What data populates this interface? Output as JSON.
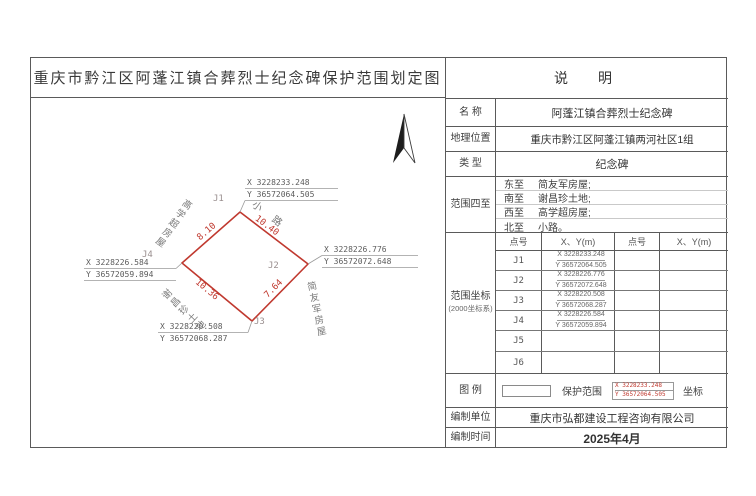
{
  "page": {
    "title": "重庆市黔江区阿蓬江镇合葬烈士纪念碑保护范围划定图"
  },
  "map": {
    "north_arrow": "north-arrow",
    "points": [
      {
        "id": "J1",
        "x": "X 3228233.248",
        "y": "Y 36572064.505"
      },
      {
        "id": "J2",
        "x": "X 3228226.776",
        "y": "Y 36572072.648"
      },
      {
        "id": "J3",
        "x": "X 3228220.508",
        "y": "Y 36572068.287"
      },
      {
        "id": "J4",
        "x": "X 3228226.584",
        "y": "Y 36572059.894"
      },
      {
        "id": "J5",
        "x": "",
        "y": ""
      },
      {
        "id": "J6",
        "x": "",
        "y": ""
      }
    ],
    "dimensions": {
      "j1_j2": "10.40",
      "j2_j3": "7.64",
      "j3_j4": "10.36",
      "j4_j1": "8.10"
    },
    "neighbors": {
      "north": "小  路",
      "east": "简友军房屋",
      "south": "谢昌珍土地",
      "west": "高学超房屋"
    }
  },
  "panel": {
    "header": "说　明",
    "name_label": "名 称",
    "name_value": "阿蓬江镇合葬烈士纪念碑",
    "location_label": "地理位置",
    "location_value": "重庆市黔江区阿蓬江镇两河社区1组",
    "type_label": "类 型",
    "type_value": "纪念碑",
    "boundary_label": "范围四至",
    "boundary_rows": [
      {
        "dir": "东至",
        "value": "简友军房屋;"
      },
      {
        "dir": "南至",
        "value": "谢昌珍土地;"
      },
      {
        "dir": "西至",
        "value": "高学超房屋;"
      },
      {
        "dir": "北至",
        "value": "小路。"
      }
    ],
    "coords_label_line1": "范围坐标",
    "coords_label_line2": "(2000坐标系)",
    "coords_header": {
      "point": "点号",
      "xy": "X、Y(m)",
      "point2": "点号",
      "xy2": "X、Y(m)"
    },
    "legend_label": "图 例",
    "legend_range_text": "保护范围",
    "legend_coord_text": "坐标",
    "legend_sample": {
      "x": "X 3228233.248",
      "y": "Y 36572064.505"
    },
    "producer_label": "编制单位",
    "producer_value": "重庆市弘都建设工程咨询有限公司",
    "date_label": "编制时间",
    "date_value": "2025年4月"
  },
  "colors": {
    "boundary_red": "#c0392f",
    "leader_gray": "#9a9a9a",
    "border_dark": "#5a5a5a"
  }
}
